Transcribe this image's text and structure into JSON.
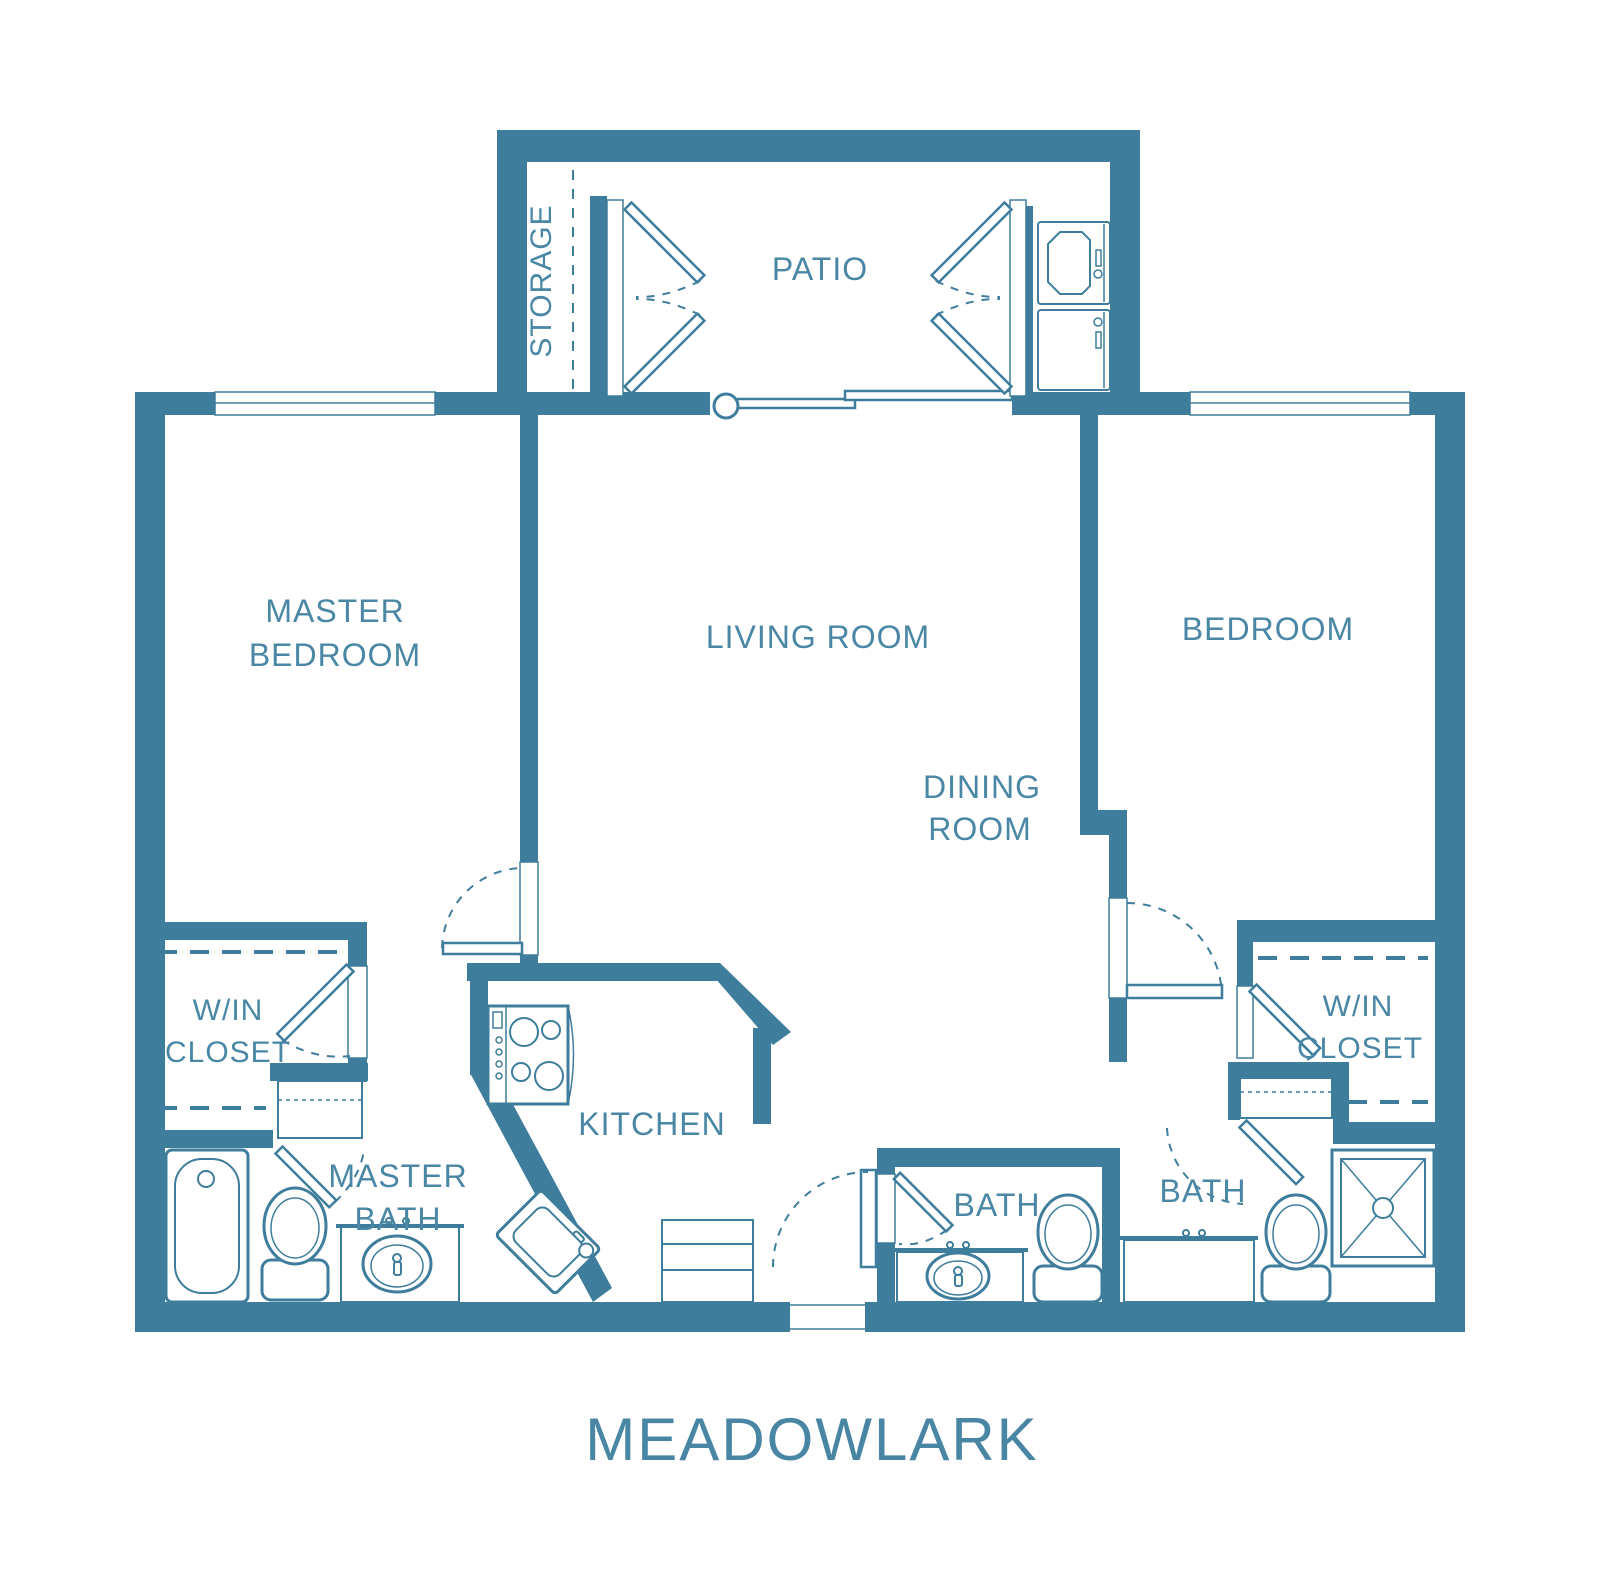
{
  "title": "MEADOWLARK",
  "colors": {
    "wall": "#3E7D9B",
    "label": "#4987A5",
    "background": "#FFFFFF"
  },
  "rooms": {
    "storage": {
      "label": "STORAGE"
    },
    "patio": {
      "label": "PATIO"
    },
    "master_bedroom": {
      "line1": "MASTER",
      "line2": "BEDROOM"
    },
    "living_room": {
      "label": "LIVING ROOM"
    },
    "bedroom": {
      "label": "BEDROOM"
    },
    "dining_room": {
      "line1": "DINING",
      "line2": "ROOM"
    },
    "win_closet_left": {
      "line1": "W/IN",
      "line2": "CLOSET"
    },
    "win_closet_right": {
      "line1": "W/IN",
      "line2": "CLOSET"
    },
    "master_bath": {
      "line1": "MASTER",
      "line2": "BATH"
    },
    "kitchen": {
      "label": "KITCHEN"
    },
    "bath_middle": {
      "label": "BATH"
    },
    "bath_right": {
      "label": "BATH"
    }
  }
}
